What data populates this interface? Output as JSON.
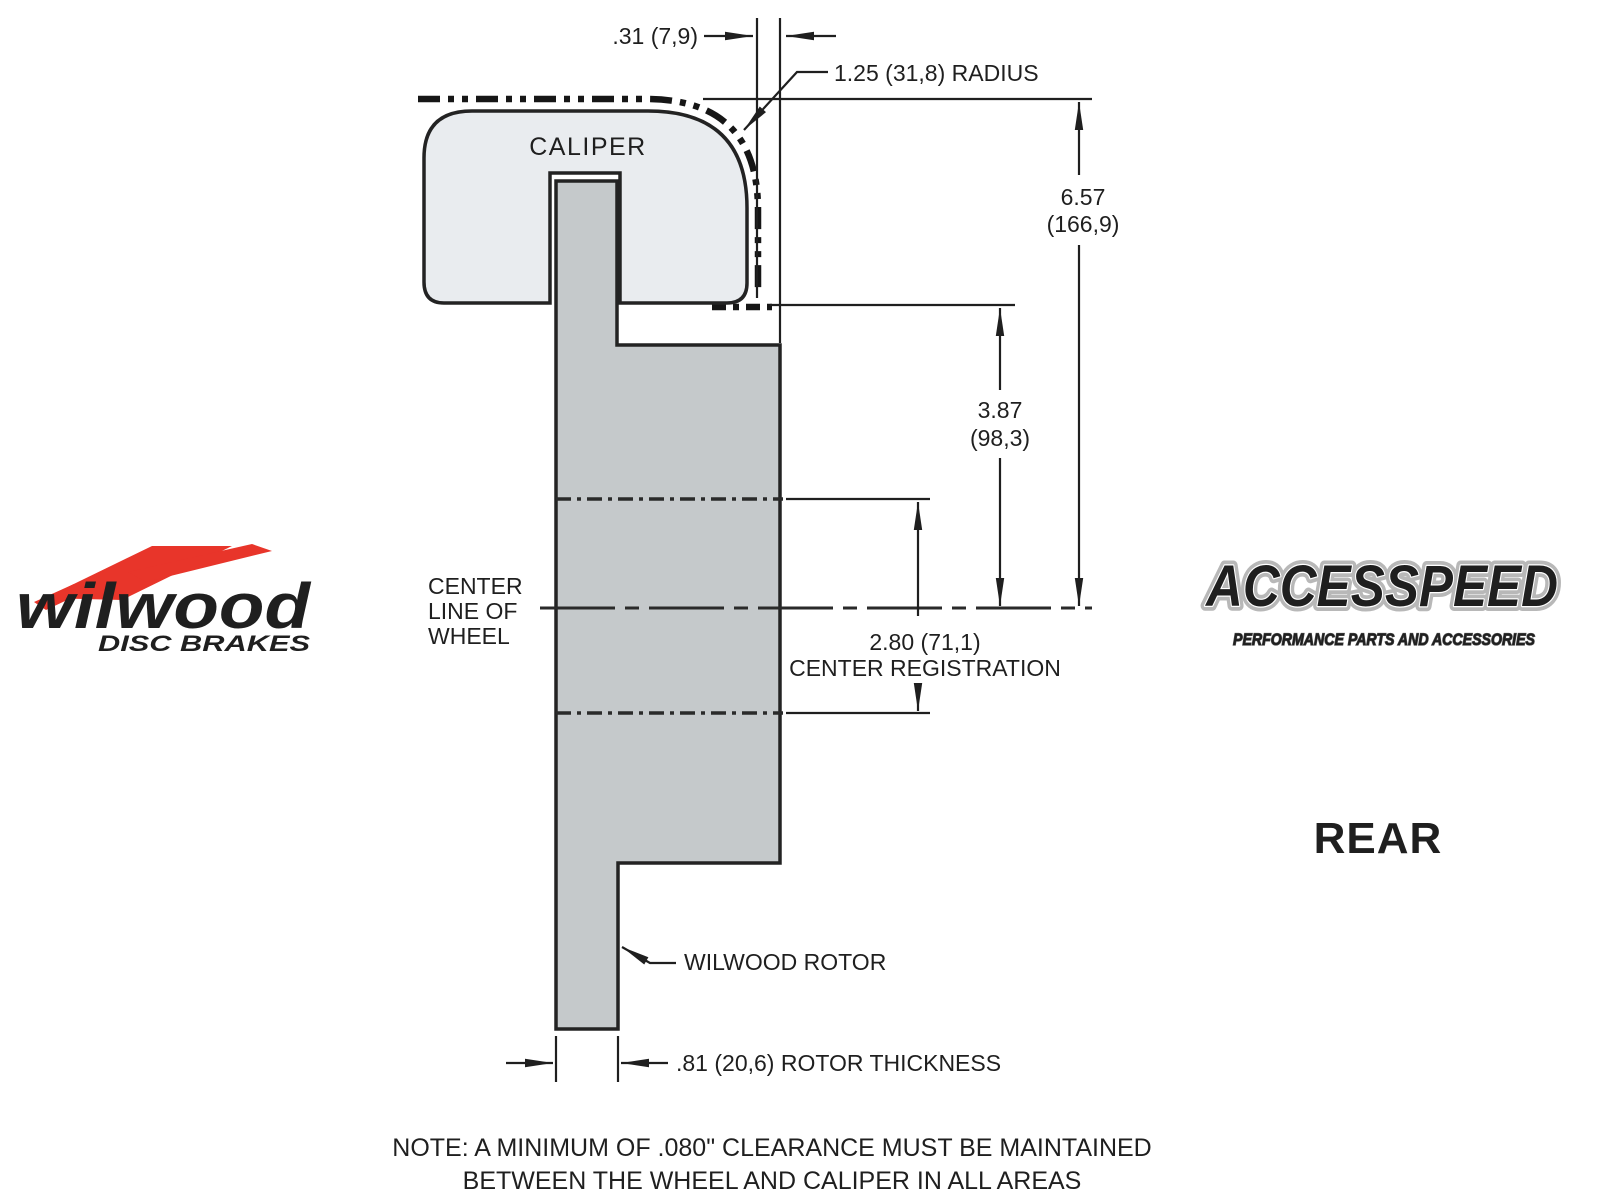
{
  "colors": {
    "caliper_fill": "#e9ecef",
    "rotor_fill": "#c5c9cb",
    "line": "#1f1f1f",
    "wilwood_red": "#e8352a"
  },
  "diagram": {
    "caliper_label": "CALIPER",
    "dim_caliper_wheel_gap": ".31 (7,9)",
    "dim_radius": "1.25 (31,8) RADIUS",
    "dim_overall_in": "6.57",
    "dim_overall_mm": "(166,9)",
    "dim_mount_in": "3.87",
    "dim_mount_mm": "(98,3)",
    "dim_register": "2.80 (71,1)",
    "dim_register_label": "CENTER REGISTRATION",
    "centerline_label_1": "CENTER",
    "centerline_label_2": "LINE OF",
    "centerline_label_3": "WHEEL",
    "rotor_label": "WILWOOD ROTOR",
    "dim_rotor_thickness": ".81 (20,6) ROTOR THICKNESS",
    "note_line_1": "NOTE: A MINIMUM OF .080\" CLEARANCE MUST BE MAINTAINED",
    "note_line_2": "BETWEEN THE WHEEL AND CALIPER IN ALL AREAS"
  },
  "branding": {
    "wilwood_name": "wilwood",
    "wilwood_tagline": "DISC BRAKES",
    "accesspeed_name": "ACCESSPEED",
    "accesspeed_tagline": "PERFORMANCE PARTS AND ACCESSORIES",
    "view_label": "REAR"
  }
}
